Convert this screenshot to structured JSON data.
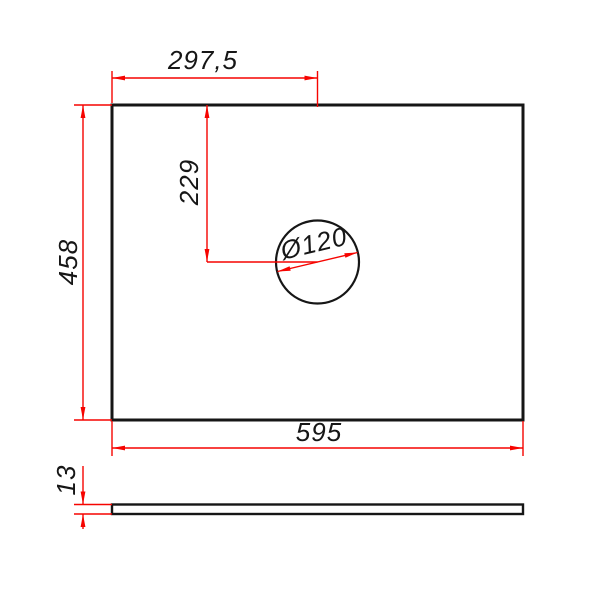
{
  "drawing": {
    "kind": "technical-dimension-drawing",
    "views": {
      "front_view": "panel face with circular hole",
      "side_view": "panel edge (thickness)"
    },
    "dimensions": {
      "hole_offset_x": "297,5",
      "hole_offset_y": "229",
      "hole_diameter": "Ø120",
      "panel_height": "458",
      "panel_width": "595",
      "panel_thickness": "13"
    },
    "colors": {
      "dimension_lines": "#f60400",
      "outlines": "#161616",
      "background": "#ffffff"
    }
  }
}
